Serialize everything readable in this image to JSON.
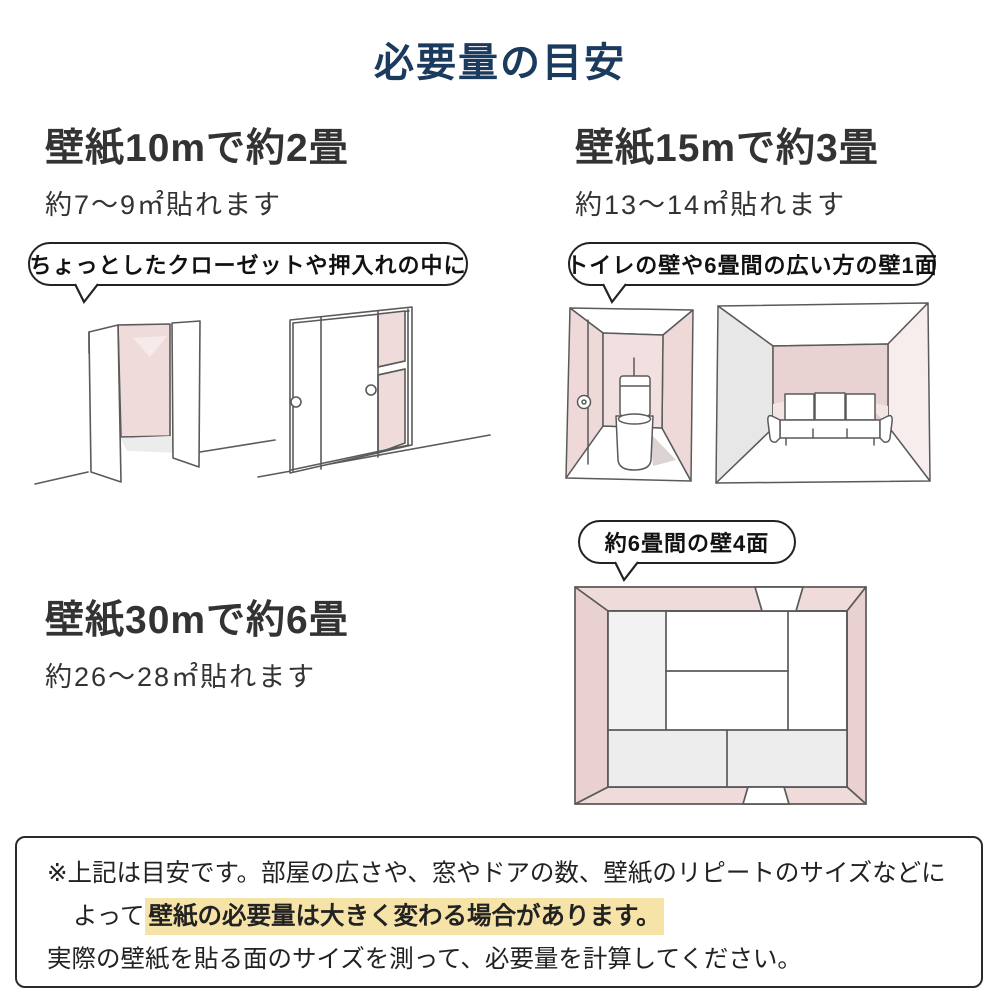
{
  "page": {
    "title": "必要量の目安"
  },
  "sections": {
    "ten": {
      "heading": "壁紙10mで約2畳",
      "subtext": "約7〜9㎡貼れます",
      "bubble": "ちょっとしたクローゼットや押入れの中に"
    },
    "fifteen": {
      "heading": "壁紙15mで約3畳",
      "subtext": "約13〜14㎡貼れます",
      "bubble": "トイレの壁や6畳間の広い方の壁1面"
    },
    "thirty": {
      "heading": "壁紙30mで約6畳",
      "subtext": "約26〜28㎡貼れます",
      "bubble": "約6畳間の壁4面"
    }
  },
  "illustrations": {
    "closet_open": "open-closet-sketch",
    "closet_sliding": "sliding-door-closet-sketch",
    "toilet": "toilet-room-sketch",
    "living_room": "six-mat-room-one-wall-sketch",
    "tatami_room": "six-mat-room-top-view-sketch"
  },
  "note": {
    "line1": "※上記は目安です。部屋の広さや、窓やドアの数、壁紙のリピートのサイズなどに",
    "line2_prefix": "よって",
    "line2_highlight": "壁紙の必要量は大きく変わる場合があります。",
    "line3": "実際の壁紙を貼る面のサイズを測って、必要量を計算してください。"
  },
  "colors": {
    "title_navy": "#1a3a5e",
    "wall_pink": "#f0dbdb",
    "wall_pink_dark": "#e9d1d1",
    "highlight_yellow": "#f5e3a8"
  }
}
